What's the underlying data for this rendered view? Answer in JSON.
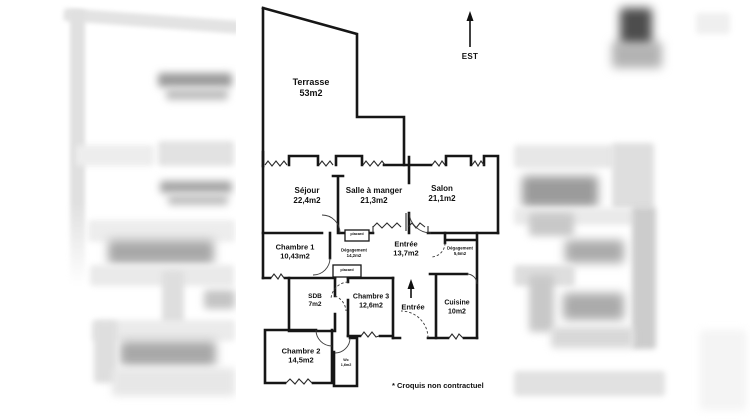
{
  "floor_plan": {
    "compass": {
      "label": "EST"
    },
    "entrance": {
      "label": "Entrée"
    },
    "note": "* Croquis non contractuel",
    "rooms": {
      "terrasse": {
        "name": "Terrasse",
        "area": "53m2"
      },
      "sejour": {
        "name": "Séjour",
        "area": "22,4m2"
      },
      "salle_a_manger": {
        "name": "Salle à manger",
        "area": "21,3m2"
      },
      "salon": {
        "name": "Salon",
        "area": "21,1m2"
      },
      "chambre1": {
        "name": "Chambre 1",
        "area": "10,43m2"
      },
      "degagement_grand": {
        "name": "Dégagement",
        "area": "14,2m2"
      },
      "entree_hall": {
        "name": "Entrée",
        "area": "13,7m2"
      },
      "degagement_petit": {
        "name": "Dégagement",
        "area": "5,6m2"
      },
      "placard_haut": {
        "name": "placard"
      },
      "placard_bas": {
        "name": "placard"
      },
      "sdb": {
        "name": "SDB",
        "area": "7m2"
      },
      "chambre3": {
        "name": "Chambre 3",
        "area": "12,6m2"
      },
      "cuisine": {
        "name": "Cuisine",
        "area": "10m2"
      },
      "chambre2": {
        "name": "Chambre 2",
        "area": "14,5m2"
      },
      "wc": {
        "name": "Wc",
        "area": "1,6m2"
      }
    }
  }
}
